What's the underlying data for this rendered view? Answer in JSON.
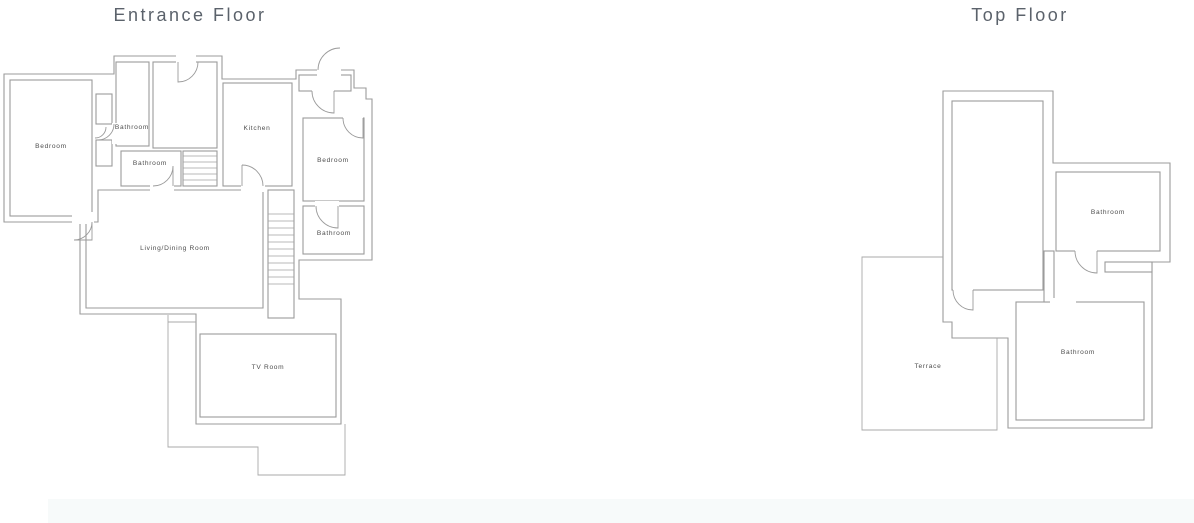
{
  "canvas": {
    "background": "#ffffff",
    "wall_color": "#9b9b9b",
    "label_color": "#4d4d4d",
    "title_color": "#5b626b",
    "footer_bar_color": "#f7fafa"
  },
  "floors": [
    {
      "title": "Entrance Floor",
      "rooms": [
        {
          "id": "bedroom-left",
          "label": "Bedroom"
        },
        {
          "id": "bathroom-top",
          "label": "Bathroom"
        },
        {
          "id": "bathroom-middle",
          "label": "Bathroom"
        },
        {
          "id": "kitchen",
          "label": "Kitchen"
        },
        {
          "id": "bedroom-right",
          "label": "Bedroom"
        },
        {
          "id": "bathroom-right",
          "label": "Bathroom"
        },
        {
          "id": "living-dining-room",
          "label": "Living/Dining Room"
        },
        {
          "id": "tv-room",
          "label": "TV Room"
        }
      ]
    },
    {
      "title": "Top Floor",
      "rooms": [
        {
          "id": "bathroom-upper",
          "label": "Bathroom"
        },
        {
          "id": "terrace",
          "label": "Terrace"
        },
        {
          "id": "bathroom-lower",
          "label": "Bathroom"
        }
      ]
    }
  ]
}
